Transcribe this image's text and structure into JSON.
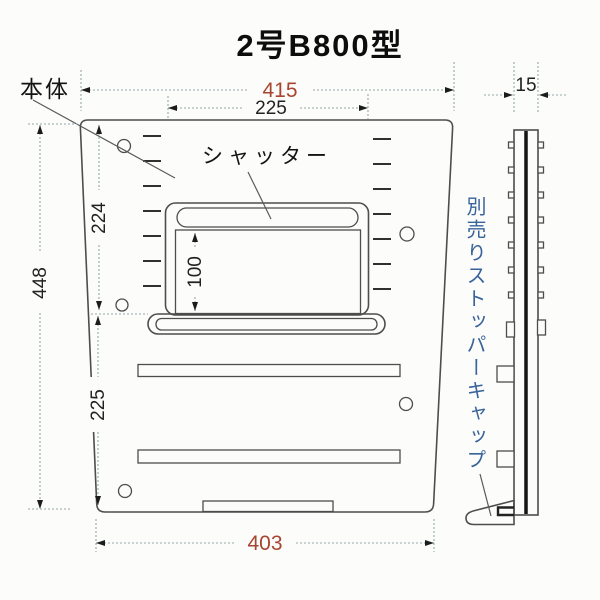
{
  "title": "2号B800型",
  "labels": {
    "body": "本体",
    "shutter": "シャッター",
    "stopper_cap": "別売りストッパーキャップ"
  },
  "dimensions": {
    "top_width": "415",
    "shutter_width": "225",
    "upper_height": "224",
    "opening_height": "100",
    "total_height": "448",
    "lower_height": "225",
    "bottom_width": "403",
    "side_thickness": "15"
  },
  "colors": {
    "accent_red": "#a84531",
    "label_blue": "#38639b",
    "outline_gray": "#4d4d4d",
    "dimension_line": "#94a9ab",
    "background": "#fcfcfa"
  }
}
